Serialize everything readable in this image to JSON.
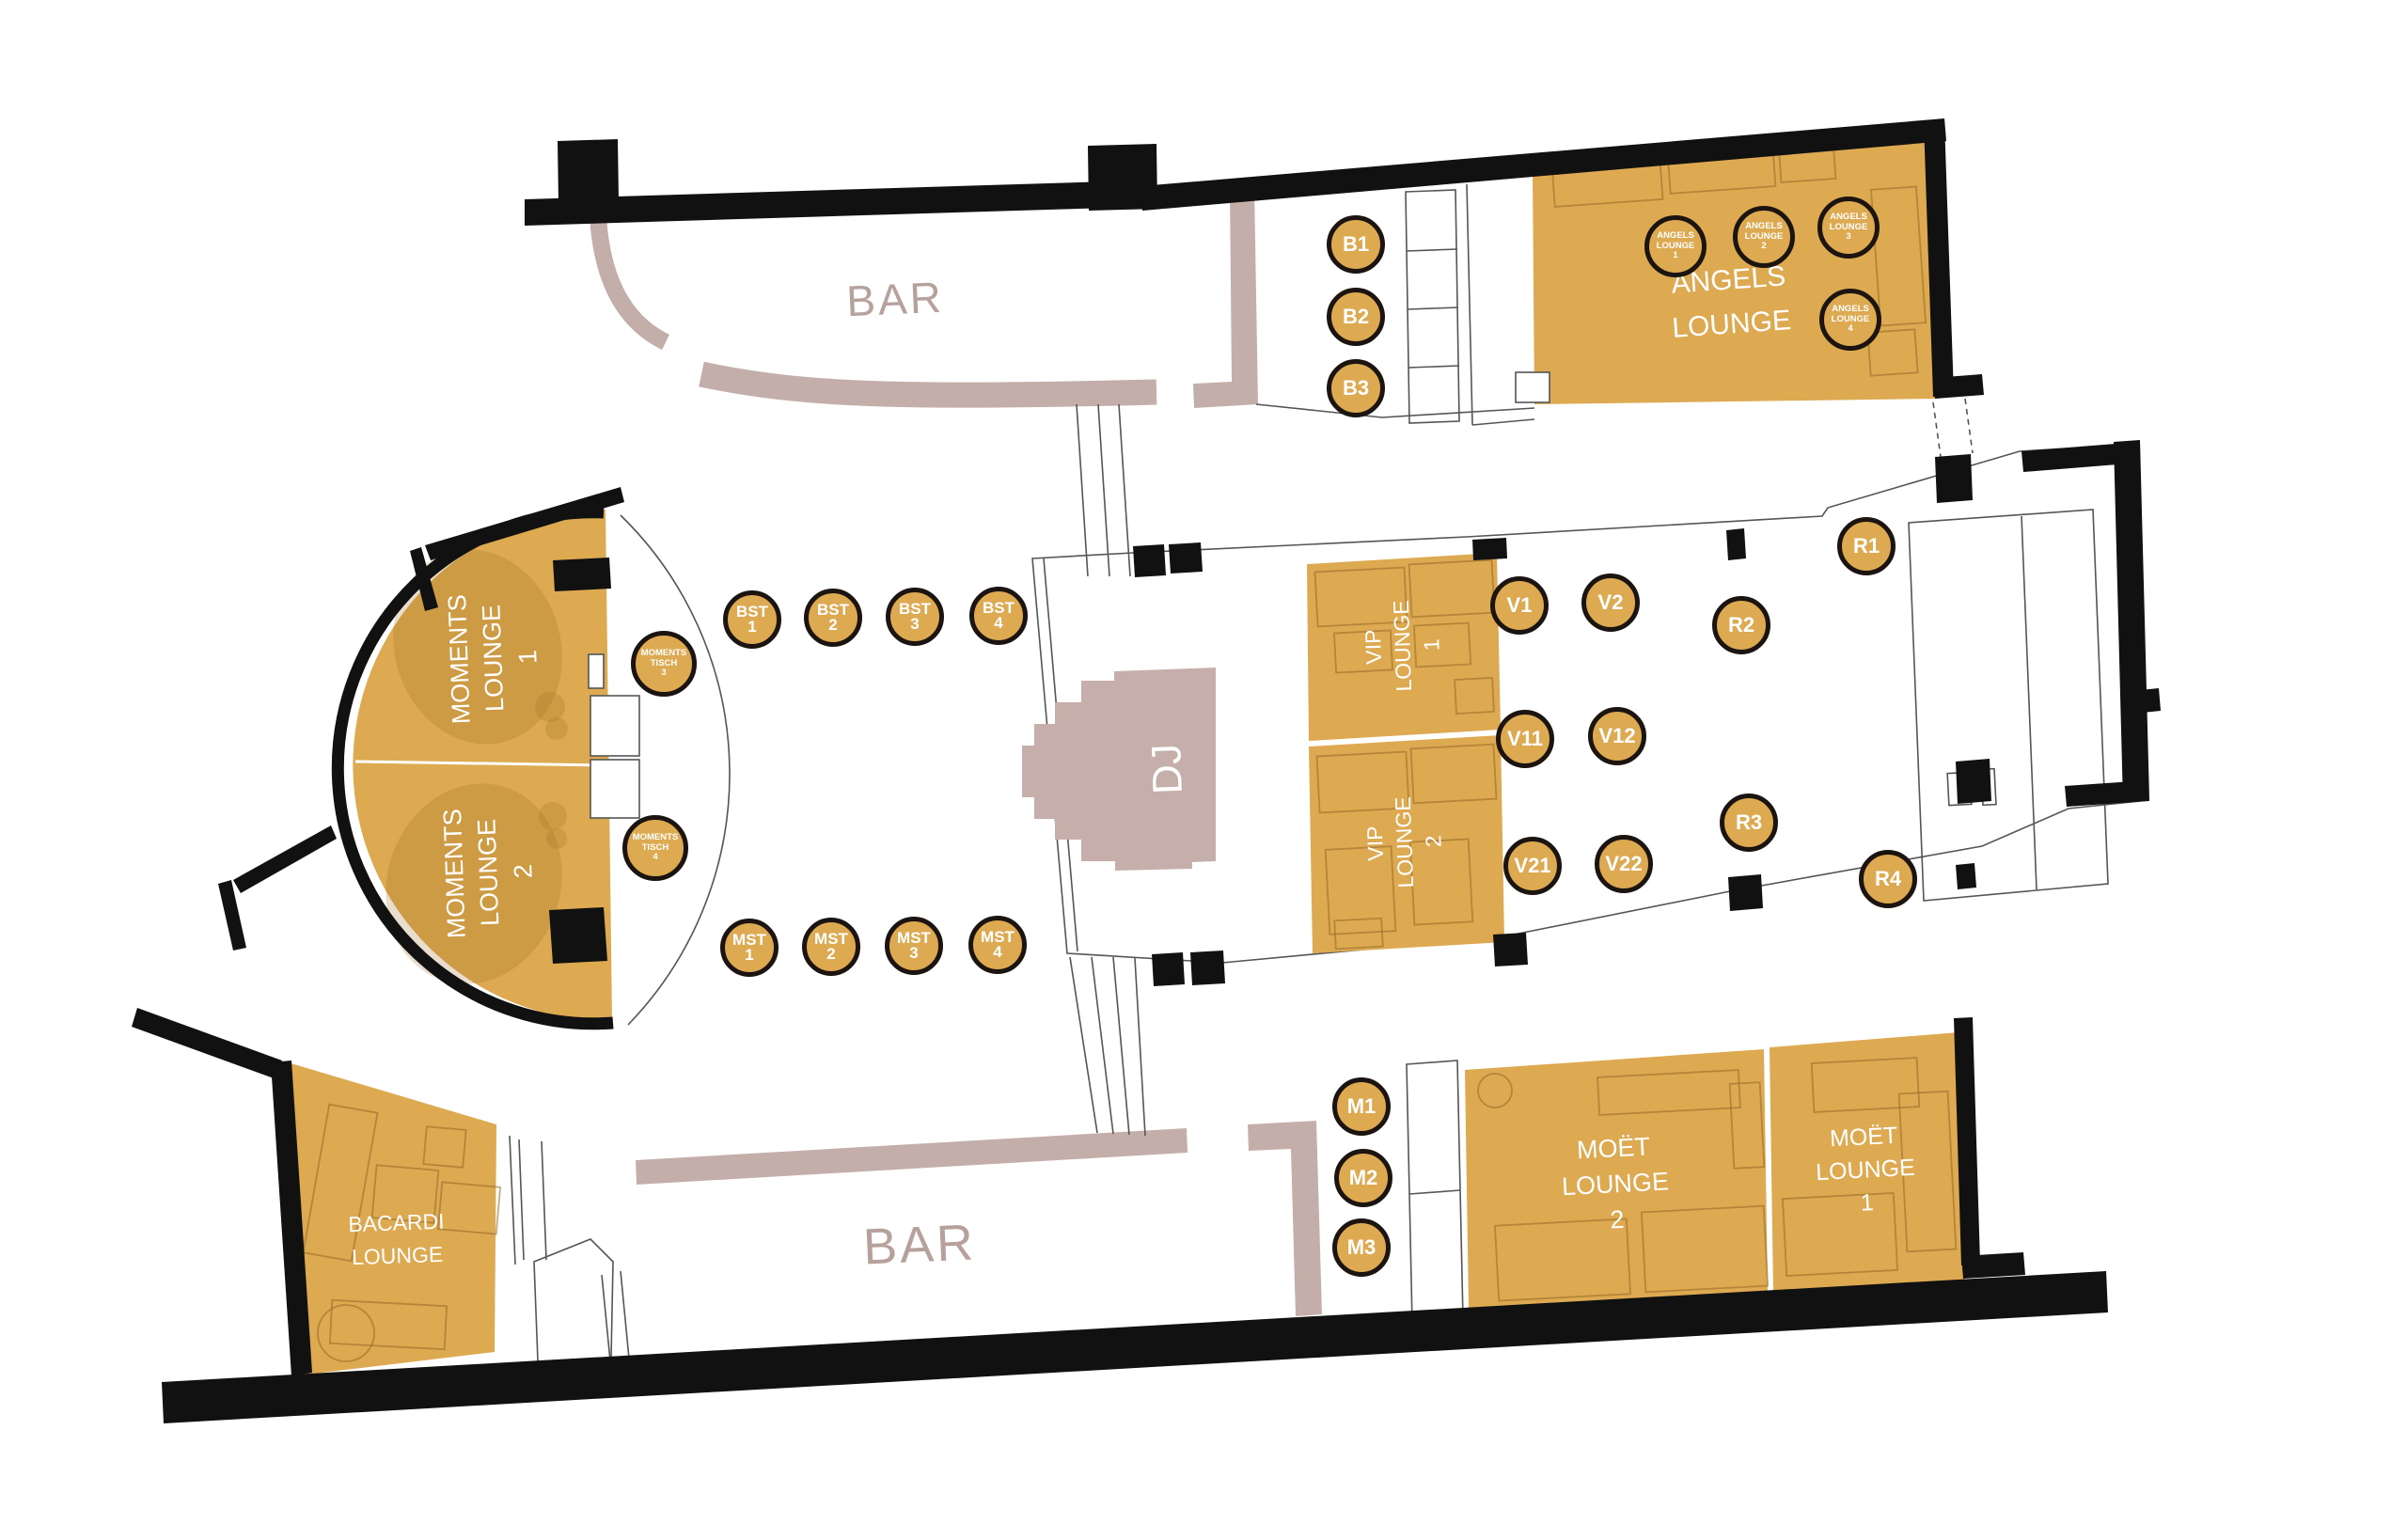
{
  "labels": {
    "bar_top": "BAR",
    "bar_bottom": "BAR",
    "dj": "DJ"
  },
  "lounges": {
    "angels": {
      "l1": "ANGELS",
      "l2": "LOUNGE"
    },
    "moments1": {
      "l1": "MOMENTS",
      "l2": "LOUNGE",
      "num": "1"
    },
    "moments2": {
      "l1": "MOMENTS",
      "l2": "LOUNGE",
      "num": "2"
    },
    "vip1": {
      "l1": "VIP",
      "l2": "LOUNGE",
      "num": "1"
    },
    "vip2": {
      "l1": "VIP",
      "l2": "LOUNGE",
      "num": "2"
    },
    "moet1": {
      "l1": "MOËT",
      "l2": "LOUNGE",
      "num": "1"
    },
    "moet2": {
      "l1": "MOËT",
      "l2": "LOUNGE",
      "num": "2"
    },
    "bacardi": {
      "l1": "BACARDI",
      "l2": "LOUNGE"
    }
  },
  "tables": {
    "b": [
      {
        "label": "B1"
      },
      {
        "label": "B2"
      },
      {
        "label": "B3"
      }
    ],
    "bst": [
      {
        "l1": "BST",
        "n": "1"
      },
      {
        "l1": "BST",
        "n": "2"
      },
      {
        "l1": "BST",
        "n": "3"
      },
      {
        "l1": "BST",
        "n": "4"
      }
    ],
    "mst": [
      {
        "l1": "MST",
        "n": "1"
      },
      {
        "l1": "MST",
        "n": "2"
      },
      {
        "l1": "MST",
        "n": "3"
      },
      {
        "l1": "MST",
        "n": "4"
      }
    ],
    "moments_tisch": [
      {
        "l1": "MOMENTS",
        "l2": "TISCH",
        "n": "3"
      },
      {
        "l1": "MOMENTS",
        "l2": "TISCH",
        "n": "4"
      }
    ],
    "v": [
      {
        "label": "V1"
      },
      {
        "label": "V2"
      },
      {
        "label": "V11"
      },
      {
        "label": "V12"
      },
      {
        "label": "V21"
      },
      {
        "label": "V22"
      }
    ],
    "r": [
      {
        "label": "R1"
      },
      {
        "label": "R2"
      },
      {
        "label": "R3"
      },
      {
        "label": "R4"
      }
    ],
    "m": [
      {
        "label": "M1"
      },
      {
        "label": "M2"
      },
      {
        "label": "M3"
      }
    ],
    "angels": [
      {
        "l1": "ANGELS",
        "l2": "LOUNGE",
        "n": "1"
      },
      {
        "l1": "ANGELS",
        "l2": "LOUNGE",
        "n": "2"
      },
      {
        "l1": "ANGELS",
        "l2": "LOUNGE",
        "n": "3"
      },
      {
        "l1": "ANGELS",
        "l2": "LOUNGE",
        "n": "4"
      }
    ]
  },
  "colors": {
    "lounge_gold": "#DDA951",
    "counter_mauve": "#C4AEAA",
    "wall_black": "#111111",
    "table_ring": "#1B1410",
    "label_white": "#FFFFFF",
    "bar_text": "#B7A19D"
  }
}
